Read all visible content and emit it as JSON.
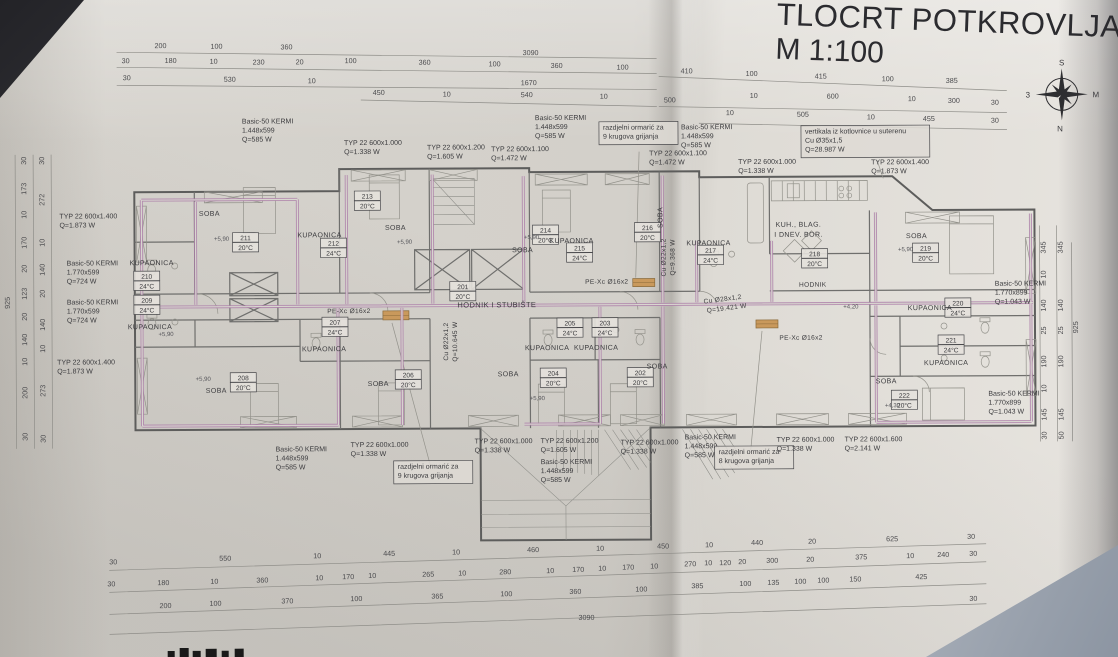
{
  "title": {
    "line1": "TLOCRT POTKROVLJA",
    "line2": "M 1:100"
  },
  "compass": {
    "top": "S",
    "right": "M",
    "bottom": "N",
    "left": "3"
  },
  "colors": {
    "paper": "#d6d3cd",
    "ink": "#3b3b3e",
    "wall": "#5d5d5c",
    "pipe": "#ad80a9",
    "cabinet": "#c9995c",
    "corner_shadow": "#8c95a2"
  },
  "rooms": [
    {
      "num": "201",
      "temp": "20°C",
      "tag": [
        463,
        288
      ],
      "name": "HODNIK I STUBIŠTE",
      "name_pos": [
        497,
        307
      ],
      "name_size": 7.5
    },
    {
      "num": "202",
      "temp": "20°C",
      "tag": [
        640,
        375
      ],
      "name": "SOBA",
      "name_pos": [
        657,
        369
      ]
    },
    {
      "num": "203",
      "temp": "24°C",
      "tag": [
        605,
        325
      ],
      "name": "KUPAONICA",
      "name_pos": [
        596,
        350
      ]
    },
    {
      "num": "204",
      "temp": "20°C",
      "tag": [
        553,
        375
      ],
      "name": "SOBA",
      "name_pos": [
        508,
        376
      ],
      "level": "+5,90",
      "level_pos": [
        537,
        400
      ]
    },
    {
      "num": "205",
      "temp": "24°C",
      "tag": [
        570,
        325
      ],
      "name": "KUPAONICA",
      "name_pos": [
        547,
        350
      ]
    },
    {
      "num": "206",
      "temp": "20°C",
      "tag": [
        408,
        376
      ],
      "name": "SOBA",
      "name_pos": [
        378,
        385
      ]
    },
    {
      "num": "207",
      "temp": "24°C",
      "tag": [
        335,
        323
      ],
      "name": "KUPAONICA",
      "name_pos": [
        324,
        350
      ]
    },
    {
      "num": "208",
      "temp": "20°C",
      "tag": [
        243,
        378
      ],
      "name": "SOBA",
      "name_pos": [
        216,
        391
      ],
      "level": "+5,90",
      "level_pos": [
        203,
        379
      ]
    },
    {
      "num": "209",
      "temp": "24°C",
      "tag": [
        147,
        300
      ],
      "name": "KUPAONICA",
      "name_pos": [
        150,
        327
      ],
      "level": "+5,90",
      "level_pos": [
        166,
        334
      ]
    },
    {
      "num": "210",
      "temp": "24°C",
      "tag": [
        147,
        276
      ],
      "name": "KUPAONICA",
      "name_pos": [
        152,
        263
      ]
    },
    {
      "num": "211",
      "temp": "20°C",
      "tag": [
        246,
        238
      ],
      "name": "SOBA",
      "name_pos": [
        210,
        214
      ],
      "level": "+5,90",
      "level_pos": [
        222,
        239
      ]
    },
    {
      "num": "212",
      "temp": "24°C",
      "tag": [
        334,
        244
      ],
      "name": "KUPAONICA",
      "name_pos": [
        320,
        236
      ]
    },
    {
      "num": "213",
      "temp": "20°C",
      "tag": [
        368,
        197
      ],
      "name": "SOBA",
      "name_pos": [
        396,
        229
      ],
      "level": "+5,90",
      "level_pos": [
        405,
        243
      ]
    },
    {
      "num": "214",
      "temp": "20°C",
      "tag": [
        546,
        232
      ],
      "name": "SOBA",
      "name_pos": [
        523,
        252
      ],
      "level": "+5,90",
      "level_pos": [
        532,
        239
      ]
    },
    {
      "num": "215",
      "temp": "24°C",
      "tag": [
        580,
        250
      ],
      "name": "KUPAONICA",
      "name_pos": [
        572,
        243
      ]
    },
    {
      "num": "216",
      "temp": "20°C",
      "tag": [
        648,
        230
      ],
      "name": "SOBA",
      "name_pos": [
        663,
        218
      ],
      "name_rot": -90
    },
    {
      "num": "217",
      "temp": "24°C",
      "tag": [
        711,
        253
      ],
      "name": "KUPAONICA",
      "name_pos": [
        709,
        246
      ]
    },
    {
      "num": "218",
      "temp": "20°C",
      "tag": [
        815,
        257
      ],
      "name": "KUH., BLAG.",
      "name_pos": [
        799,
        228
      ],
      "name2": "I DNEV. BOR.",
      "name2_pos": [
        799,
        238
      ],
      "level": "+4,20",
      "level_pos": [
        851,
        310
      ]
    },
    {
      "num": "219",
      "temp": "20°C",
      "tag": [
        926,
        252
      ],
      "name": "SOBA",
      "name_pos": [
        917,
        240
      ],
      "level": "+5,90",
      "level_pos": [
        906,
        253
      ]
    },
    {
      "num": "220",
      "temp": "24°C",
      "tag": [
        958,
        307
      ],
      "name": "KUPAONICA",
      "name_pos": [
        930,
        312
      ]
    },
    {
      "num": "221",
      "temp": "24°C",
      "tag": [
        951,
        344
      ],
      "name": "KUPAONICA",
      "name_pos": [
        946,
        367
      ]
    },
    {
      "num": "222",
      "temp": "20°C",
      "tag": [
        904,
        399
      ],
      "name": "SOBA",
      "name_pos": [
        886,
        385
      ],
      "level": "+4,30",
      "level_pos": [
        892,
        409
      ]
    }
  ],
  "annotations": [
    {
      "t": "HODNIK",
      "x": 813,
      "y": 288
    },
    {
      "t": "PE-Xc Ø16x2",
      "x": 349,
      "y": 312
    },
    {
      "t": "PE-Xc Ø16x2",
      "x": 607,
      "y": 284
    },
    {
      "t": "PE-Xc Ø16x2",
      "x": 801,
      "y": 341
    },
    {
      "t": "Cu Ø22x1,2",
      "x": 448,
      "y": 341,
      "r": -90
    },
    {
      "t": "Q=10.645 W",
      "x": 457,
      "y": 341,
      "r": -90
    },
    {
      "t": "Cu Ø22x1,2",
      "x": 666,
      "y": 258,
      "r": -90
    },
    {
      "t": "Q=9.368 W",
      "x": 675,
      "y": 258,
      "r": -90
    },
    {
      "t": "Cu Ø28x1,2",
      "x": 723,
      "y": 302,
      "r": -7
    },
    {
      "t": "Q=19.421 W",
      "x": 727,
      "y": 311,
      "r": -7
    }
  ],
  "radiator_labels": [
    {
      "lines": [
        "Basic-50 KERMI",
        "1.448x599",
        "Q=585 W"
      ],
      "x": 243,
      "y": 122
    },
    {
      "lines": [
        "TYP 22 600x1.000",
        "Q=1.338 W"
      ],
      "x": 345,
      "y": 144
    },
    {
      "lines": [
        "TYP 22 600x1.200",
        "Q=1.605 W"
      ],
      "x": 428,
      "y": 149
    },
    {
      "lines": [
        "TYP 22 600x1.100",
        "Q=1.472 W"
      ],
      "x": 492,
      "y": 151
    },
    {
      "lines": [
        "Basic-50 KERMI",
        "1.448x599",
        "Q=585 W"
      ],
      "x": 536,
      "y": 120
    },
    {
      "lines": [
        "razdjelni ormarić za",
        "9 krugova grijanja"
      ],
      "x": 604,
      "y": 130,
      "boxed": true
    },
    {
      "lines": [
        "Basic-50 KERMI",
        "1.448x599",
        "Q=585 W"
      ],
      "x": 682,
      "y": 130
    },
    {
      "lines": [
        "TYP 22 600x1.100",
        "Q=1.472 W"
      ],
      "x": 650,
      "y": 156
    },
    {
      "lines": [
        "TYP 22 600x1.000",
        "Q=1.338 W"
      ],
      "x": 739,
      "y": 165
    },
    {
      "lines": [
        "vertikala iz kotlovnice u suterenu",
        "Cu Ø35x1,5",
        "Q=28.987 W"
      ],
      "x": 806,
      "y": 135,
      "boxed": true
    },
    {
      "lines": [
        "TYP 22 600x1.400",
        "Q=1.873 W"
      ],
      "x": 872,
      "y": 166
    },
    {
      "lines": [
        "TYP 22 600x1.400",
        "Q=1.873 W"
      ],
      "x": 60,
      "y": 216
    },
    {
      "lines": [
        "Basic-50 KERMI",
        "1.770x599",
        "Q=724 W"
      ],
      "x": 67,
      "y": 263
    },
    {
      "lines": [
        "Basic-50 KERMI",
        "1.770x599",
        "Q=724 W"
      ],
      "x": 67,
      "y": 302
    },
    {
      "lines": [
        "TYP 22 600x1.400",
        "Q=1.873 W"
      ],
      "x": 57,
      "y": 362
    },
    {
      "lines": [
        "Basic-50 KERMI",
        "1.770x899",
        "Q=1.043 W"
      ],
      "x": 995,
      "y": 288
    },
    {
      "lines": [
        "Basic-50 KERMI",
        "1.770x899",
        "Q=1.043 W"
      ],
      "x": 988,
      "y": 398
    },
    {
      "lines": [
        "Basic-50 KERMI",
        "1.448x599",
        "Q=585 W"
      ],
      "x": 275,
      "y": 450
    },
    {
      "lines": [
        "TYP 22 600x1.000",
        "Q=1.338 W"
      ],
      "x": 350,
      "y": 446
    },
    {
      "lines": [
        "razdjelni ormarić za",
        "9 krugova grijanja"
      ],
      "x": 397,
      "y": 468,
      "boxed": true
    },
    {
      "lines": [
        "TYP 22 600x1.000",
        "Q=1.338 W"
      ],
      "x": 474,
      "y": 443
    },
    {
      "lines": [
        "TYP 22 600x1.200",
        "Q=1.605 W"
      ],
      "x": 540,
      "y": 443
    },
    {
      "lines": [
        "Basic-50 KERMI",
        "1.448x599",
        "Q=585 W"
      ],
      "x": 540,
      "y": 464
    },
    {
      "lines": [
        "TYP 22 600x1.000",
        "Q=1.338 W"
      ],
      "x": 620,
      "y": 445
    },
    {
      "lines": [
        "Basic-50 KERMI",
        "1.448x599",
        "Q=585 W"
      ],
      "x": 684,
      "y": 440
    },
    {
      "lines": [
        "razdjelni ormarić za",
        "8 krugova grijanja"
      ],
      "x": 718,
      "y": 455,
      "boxed": true
    },
    {
      "lines": [
        "TYP 22 600x1.000",
        "Q=1.338 W"
      ],
      "x": 776,
      "y": 443
    },
    {
      "lines": [
        "TYP 22 600x1.600",
        "Q=2.141 W"
      ],
      "x": 844,
      "y": 443
    }
  ],
  "dimensions": {
    "top": [
      [
        "200",
        162,
        46
      ],
      [
        "100",
        218,
        47
      ],
      [
        "360",
        288,
        48
      ],
      [
        "3090",
        532,
        55
      ],
      [
        "30",
        127,
        61
      ],
      [
        "180",
        172,
        61
      ],
      [
        "10",
        215,
        62
      ],
      [
        "230",
        260,
        63
      ],
      [
        "20",
        301,
        63
      ],
      [
        "100",
        352,
        62
      ],
      [
        "360",
        426,
        64
      ],
      [
        "100",
        496,
        66
      ],
      [
        "360",
        558,
        68
      ],
      [
        "100",
        624,
        70
      ],
      [
        "410",
        688,
        74
      ],
      [
        "100",
        753,
        77
      ],
      [
        "415",
        822,
        80
      ],
      [
        "100",
        889,
        83
      ],
      [
        "385",
        953,
        85
      ],
      [
        "30",
        128,
        78
      ],
      [
        "530",
        231,
        80
      ],
      [
        "10",
        313,
        82
      ],
      [
        "1670",
        530,
        85
      ],
      [
        "600",
        834,
        100
      ],
      [
        "10",
        913,
        103
      ],
      [
        "300",
        955,
        105
      ],
      [
        "30",
        996,
        107
      ],
      [
        "450",
        380,
        94
      ],
      [
        "10",
        448,
        96
      ],
      [
        "540",
        528,
        97
      ],
      [
        "10",
        605,
        99
      ],
      [
        "500",
        671,
        103
      ],
      [
        "10",
        755,
        99
      ],
      [
        "10",
        731,
        116
      ],
      [
        "505",
        804,
        118
      ],
      [
        "10",
        872,
        121
      ],
      [
        "455",
        930,
        123
      ],
      [
        "30",
        996,
        125
      ]
    ],
    "bottom": [
      [
        "30",
        112,
        562
      ],
      [
        "550",
        224,
        559
      ],
      [
        "10",
        316,
        557
      ],
      [
        "445",
        388,
        555
      ],
      [
        "10",
        455,
        554
      ],
      [
        "460",
        532,
        552
      ],
      [
        "10",
        599,
        551
      ],
      [
        "450",
        662,
        549
      ],
      [
        "10",
        708,
        548
      ],
      [
        "440",
        756,
        546
      ],
      [
        "20",
        811,
        545
      ],
      [
        "625",
        891,
        543
      ],
      [
        "30",
        970,
        541
      ],
      [
        "30",
        110,
        584
      ],
      [
        "180",
        162,
        583
      ],
      [
        "10",
        213,
        582
      ],
      [
        "360",
        261,
        581
      ],
      [
        "10",
        318,
        579
      ],
      [
        "170",
        347,
        578
      ],
      [
        "10",
        371,
        577
      ],
      [
        "265",
        427,
        576
      ],
      [
        "10",
        461,
        575
      ],
      [
        "280",
        504,
        574
      ],
      [
        "10",
        549,
        573
      ],
      [
        "170",
        577,
        572
      ],
      [
        "10",
        601,
        571
      ],
      [
        "170",
        627,
        570
      ],
      [
        "10",
        653,
        569
      ],
      [
        "270",
        689,
        567
      ],
      [
        "10",
        707,
        566
      ],
      [
        "120",
        724,
        566
      ],
      [
        "20",
        741,
        565
      ],
      [
        "300",
        771,
        564
      ],
      [
        "20",
        809,
        563
      ],
      [
        "375",
        860,
        561
      ],
      [
        "10",
        909,
        560
      ],
      [
        "240",
        942,
        559
      ],
      [
        "30",
        972,
        558
      ],
      [
        "200",
        164,
        606
      ],
      [
        "100",
        214,
        604
      ],
      [
        "370",
        286,
        602
      ],
      [
        "100",
        355,
        600
      ],
      [
        "365",
        436,
        598
      ],
      [
        "100",
        505,
        596
      ],
      [
        "360",
        574,
        594
      ],
      [
        "100",
        640,
        592
      ],
      [
        "385",
        696,
        589
      ],
      [
        "100",
        744,
        587
      ],
      [
        "135",
        772,
        586
      ],
      [
        "100",
        799,
        585
      ],
      [
        "100",
        822,
        584
      ],
      [
        "150",
        854,
        583
      ],
      [
        "425",
        920,
        581
      ],
      [
        "3090",
        585,
        620
      ],
      [
        "30",
        972,
        603
      ]
    ],
    "left": [
      [
        "30",
        27,
        158
      ],
      [
        "173",
        27,
        186
      ],
      [
        "10",
        27,
        212
      ],
      [
        "170",
        27,
        240
      ],
      [
        "20",
        27,
        266
      ],
      [
        "123",
        27,
        291
      ],
      [
        "20",
        27,
        314
      ],
      [
        "140",
        27,
        337
      ],
      [
        "10",
        27,
        359
      ],
      [
        "200",
        27,
        390
      ],
      [
        "30",
        27,
        434
      ],
      [
        "30",
        45,
        158
      ],
      [
        "272",
        45,
        197
      ],
      [
        "10",
        45,
        240
      ],
      [
        "140",
        45,
        267
      ],
      [
        "20",
        45,
        291
      ],
      [
        "140",
        45,
        322
      ],
      [
        "10",
        45,
        346
      ],
      [
        "273",
        45,
        388
      ],
      [
        "30",
        45,
        436
      ],
      [
        "925",
        10,
        300
      ]
    ],
    "right": [
      [
        "345",
        1046,
        250
      ],
      [
        "10",
        1046,
        277
      ],
      [
        "140",
        1046,
        308
      ],
      [
        "25",
        1046,
        333
      ],
      [
        "190",
        1046,
        364
      ],
      [
        "10",
        1046,
        391
      ],
      [
        "145",
        1046,
        417
      ],
      [
        "30",
        1046,
        438
      ],
      [
        "345",
        1063,
        250
      ],
      [
        "140",
        1063,
        308
      ],
      [
        "25",
        1063,
        333
      ],
      [
        "190",
        1063,
        364
      ],
      [
        "145",
        1063,
        417
      ],
      [
        "50",
        1063,
        438
      ],
      [
        "925",
        1078,
        330
      ]
    ]
  }
}
